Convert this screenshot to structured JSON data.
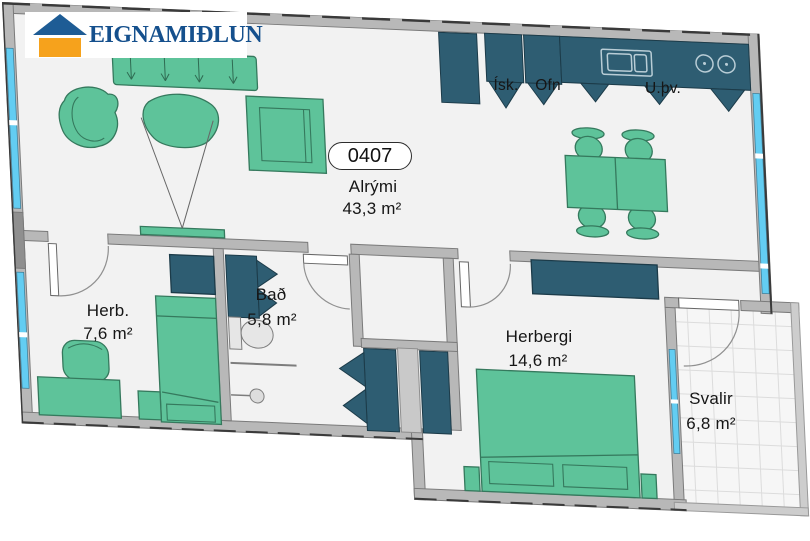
{
  "logo": {
    "text": "EIGNAMIÐLUN"
  },
  "unit": {
    "number": "0407"
  },
  "rooms": {
    "alrymi": {
      "name": "Alrými",
      "area": "43,3 m²"
    },
    "herb": {
      "name": "Herb.",
      "area": "7,6 m²"
    },
    "bad": {
      "name": "Bað",
      "area": "5,8 m²"
    },
    "herbergi": {
      "name": "Herbergi",
      "area": "14,6 m²"
    },
    "svalir": {
      "name": "Svalir",
      "area": "6,8 m²"
    }
  },
  "kitchen": {
    "fridge": "Ísk.",
    "oven": "Ofn",
    "utility": "U.þv."
  },
  "colors": {
    "furniture_green": "#5ec39a",
    "cabinet_teal": "#2e5d72",
    "window_glass": "#63cdf2",
    "wall_gray": "#b8b8b8",
    "floor": "#f2f2f2",
    "logo_blue": "#15508d",
    "logo_orange": "#f6a21c"
  }
}
